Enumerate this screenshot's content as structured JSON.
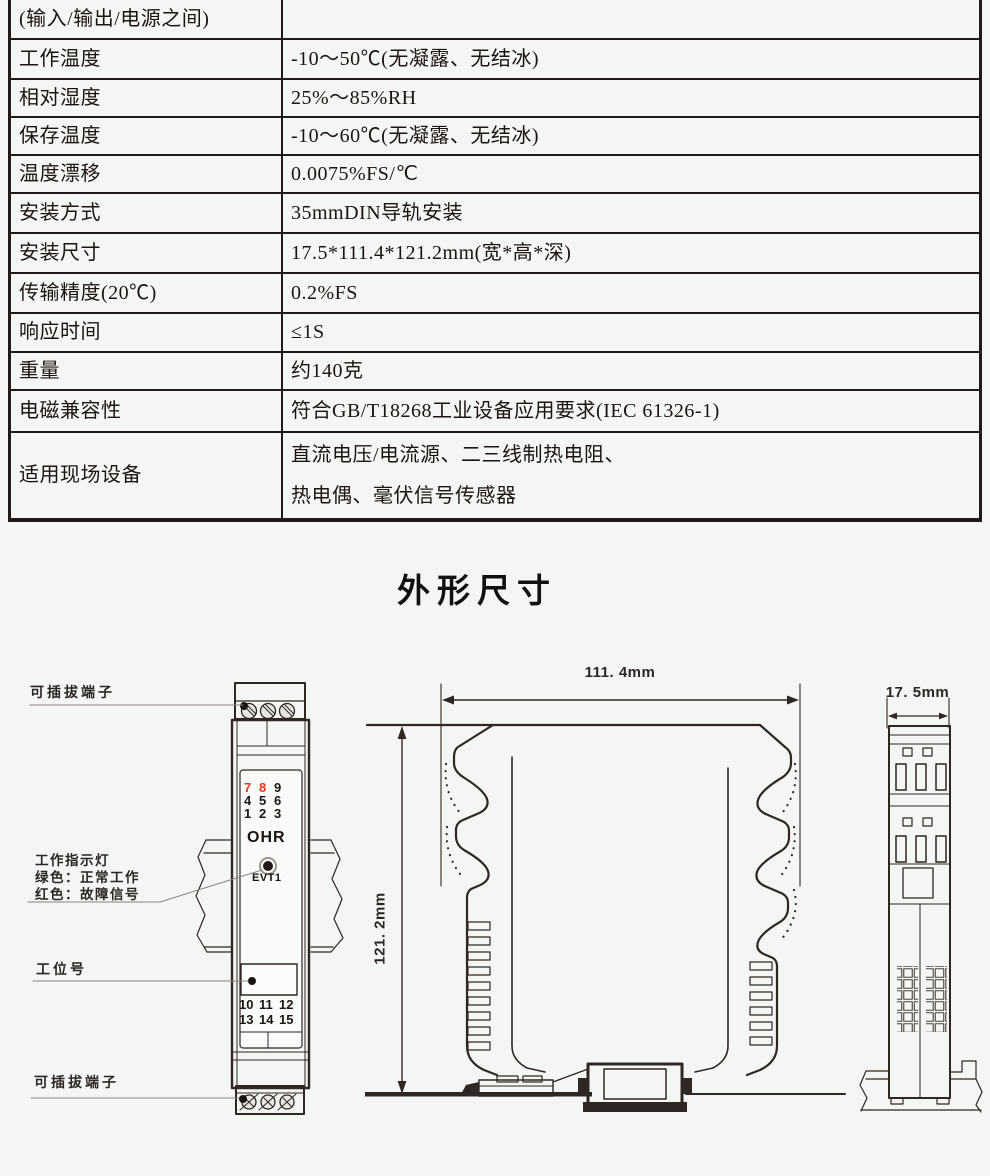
{
  "page": {
    "background": "#f5f5f3",
    "line_color": "#2e2723"
  },
  "spec_table": {
    "rows": [
      {
        "label": "(输入/输出/电源之间)",
        "value": ""
      },
      {
        "label": "工作温度",
        "value": "-10～50℃(无凝露、无结冰)"
      },
      {
        "label": "相对湿度",
        "value": "25%～85%RH"
      },
      {
        "label": "保存温度",
        "value": "-10～60℃(无凝露、无结冰)"
      },
      {
        "label": "温度漂移",
        "value": "0.0075%FS/℃"
      },
      {
        "label": "安装方式",
        "value": "35mmDIN导轨安装"
      },
      {
        "label": "安装尺寸",
        "value": "17.5*111.4*121.2mm(宽*高*深)"
      },
      {
        "label": "传输精度(20℃)",
        "value": "0.2%FS"
      },
      {
        "label": "响应时间",
        "value": "≤1S"
      },
      {
        "label": "重量",
        "value": "约140克"
      },
      {
        "label": "电磁兼容性",
        "value": "符合GB/T18268工业设备应用要求(IEC 61326-1)"
      },
      {
        "label": "适用现场设备",
        "value": "直流电压/电流源、二三线制热电阻、\n热电偶、毫伏信号传感器"
      }
    ]
  },
  "section_title": "外形尺寸",
  "outline_drawing": {
    "labels": {
      "terminal_top": "可插拔端子",
      "indicator_line1": "工作指示灯",
      "indicator_line2": "绿色：正常工作",
      "indicator_line3": "红色：故障信号",
      "station_no": "工位号",
      "terminal_bottom": "可插拔端子"
    },
    "front_view": {
      "logo": "OHR",
      "led_label": "EVT1",
      "numbers_top": [
        "7",
        "8",
        "9",
        "4",
        "5",
        "6",
        "1",
        "2",
        "3"
      ],
      "numbers_bottom": [
        "10",
        "11",
        "12",
        "13",
        "14",
        "15"
      ]
    },
    "dimensions": {
      "width_label": "111. 4mm",
      "height_label": "121. 2mm",
      "depth_label": "17. 5mm"
    },
    "colors": {
      "red_terminal": "#e5371b",
      "line": "#2e2723"
    }
  }
}
